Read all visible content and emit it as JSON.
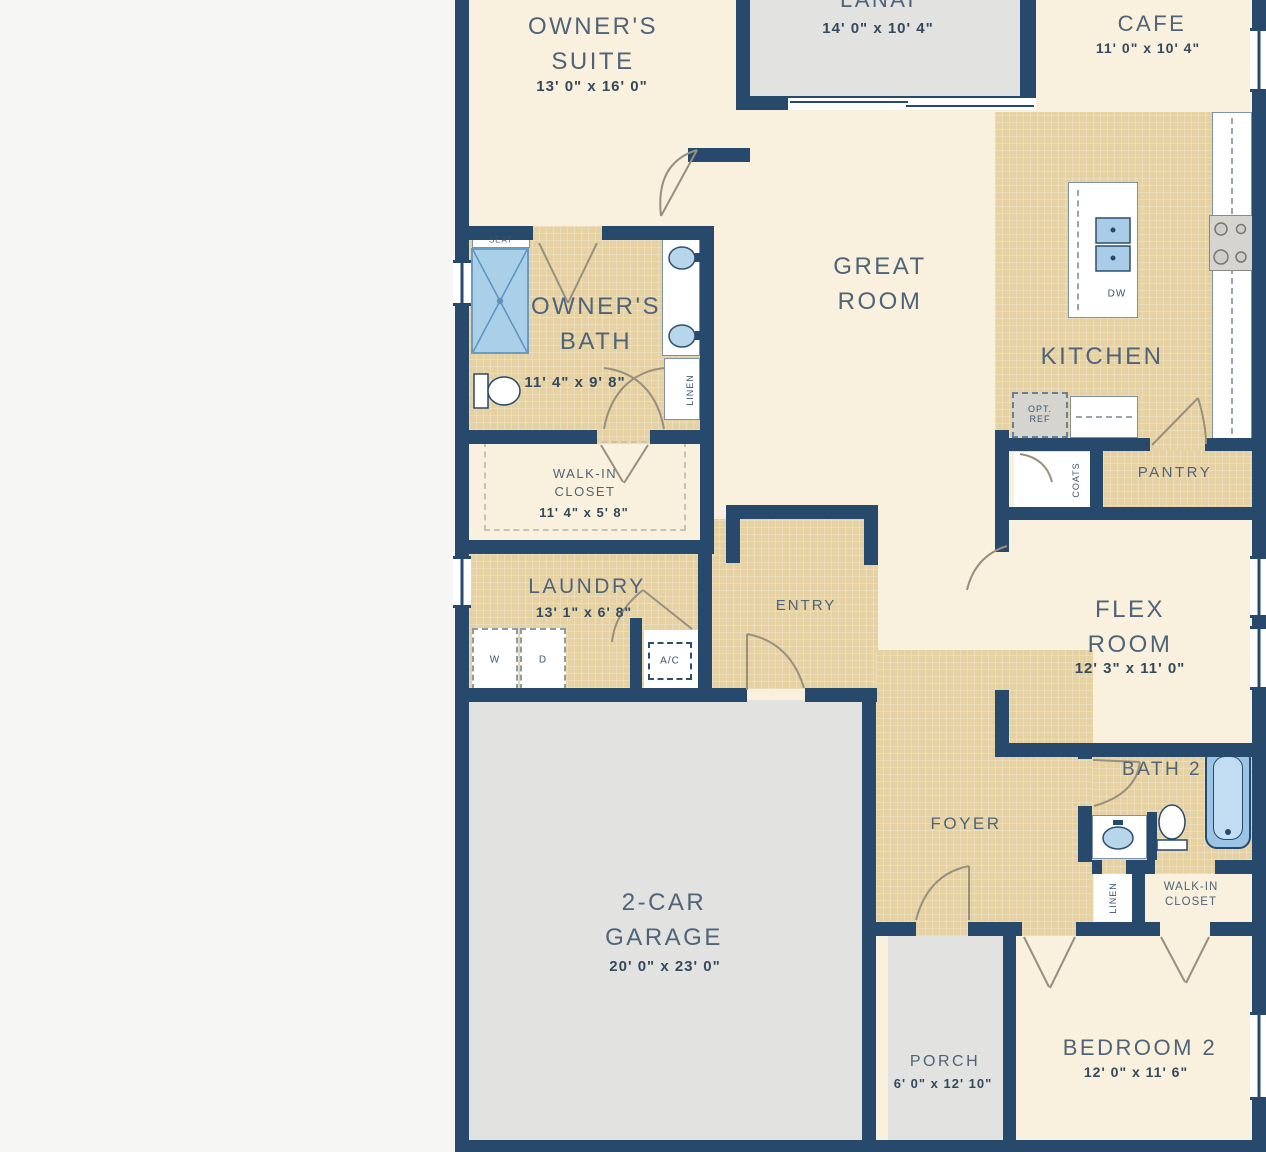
{
  "plan_title": "Single-story home floor plan",
  "colors": {
    "wall": "#26496c",
    "floor_cream": "#f9f1dd",
    "floor_tan": "#e6d1a3",
    "floor_gray": "#e2e2e0",
    "fixture_blue": "#a9cde9",
    "page_background": "#f6f6f5"
  },
  "rooms": {
    "owners_suite": {
      "name": "OWNER'S SUITE",
      "dims": "13' 0\" x 16' 0\""
    },
    "lanai": {
      "name": "LANAI",
      "dims": "14' 0\" x 10' 4\""
    },
    "cafe": {
      "name": "CAFE",
      "dims": "11' 0\" x 10' 4\""
    },
    "great_room": {
      "name": "GREAT ROOM"
    },
    "kitchen": {
      "name": "KITCHEN"
    },
    "owners_bath": {
      "name": "OWNER'S BATH",
      "dims": "11' 4\" x 9' 8\""
    },
    "walkin_closet_1": {
      "name": "WALK-IN CLOSET",
      "dims": "11' 4\" x 5' 8\""
    },
    "laundry": {
      "name": "LAUNDRY",
      "dims": "13' 1\" x 6' 8\""
    },
    "entry": {
      "name": "ENTRY"
    },
    "flex_room": {
      "name": "FLEX ROOM",
      "dims": "12' 3\" x 11' 0\""
    },
    "pantry": {
      "name": "PANTRY"
    },
    "coats": {
      "name": "COATS"
    },
    "garage": {
      "name": "2-CAR GARAGE",
      "dims": "20' 0\" x 23' 0\""
    },
    "foyer": {
      "name": "FOYER"
    },
    "bath_2": {
      "name": "BATH 2"
    },
    "linen_1": {
      "name": "LINEN"
    },
    "linen_2": {
      "name": "LINEN"
    },
    "walkin_closet_2": {
      "name": "WALK-IN CLOSET"
    },
    "porch": {
      "name": "PORCH",
      "dims": "6' 0\" x 12' 10\""
    },
    "bedroom_2": {
      "name": "BEDROOM 2",
      "dims": "12' 0\" x 11' 6\""
    }
  },
  "fixtures": {
    "seat": "SEAT",
    "washer": "W",
    "dryer": "D",
    "ac": "A/C",
    "dishwasher": "DW",
    "opt_ref": "OPT. REF"
  }
}
